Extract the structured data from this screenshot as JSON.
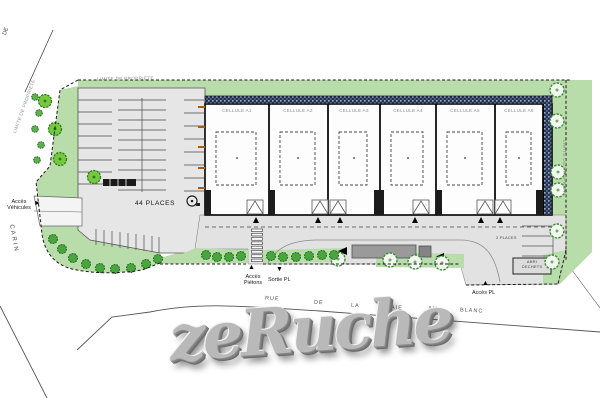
{
  "plan": {
    "boundary_label": "LIMITE DE PROPRIETE",
    "left_street": {
      "word1": "DE",
      "word2": "CARIN"
    },
    "bottom_street": {
      "word1": "RUE",
      "word2": "DE",
      "word3": "LA",
      "word4": "HAIE",
      "word5": "AU",
      "word6": "BLANC"
    },
    "parking": {
      "label": "44 PLACES"
    },
    "small_parking": {
      "label": "3 PLACES"
    },
    "building": {
      "cells": [
        {
          "label": "CELLULE A1"
        },
        {
          "label": "CELLULE A2"
        },
        {
          "label": "CELLULE A3"
        },
        {
          "label": "CELLULE A4"
        },
        {
          "label": "CELLULE A5"
        },
        {
          "label": "CELLULE A6"
        }
      ]
    },
    "access": {
      "vehicles_line1": "Accès",
      "vehicles_line2": "Véhicules",
      "pedestrians_line1": "Accès",
      "pedestrians_line2": "Piétons",
      "exit_pl": "Sortie PL",
      "entry_pl": "Accès PL"
    },
    "waste_shelter": {
      "line1": "ABRI",
      "line2": "DECHETS"
    },
    "watermark": "zeRuche",
    "icons": {
      "arrow_right": "►",
      "arrow_up": "▲",
      "arrow_down": "▼",
      "arrow_left": "◄"
    },
    "colors": {
      "landscape_green": "#b9dcab",
      "dark_hatch": "#26324d",
      "surface_gray": "#e4e4e4",
      "accent_orange": "#a85b1a"
    }
  }
}
